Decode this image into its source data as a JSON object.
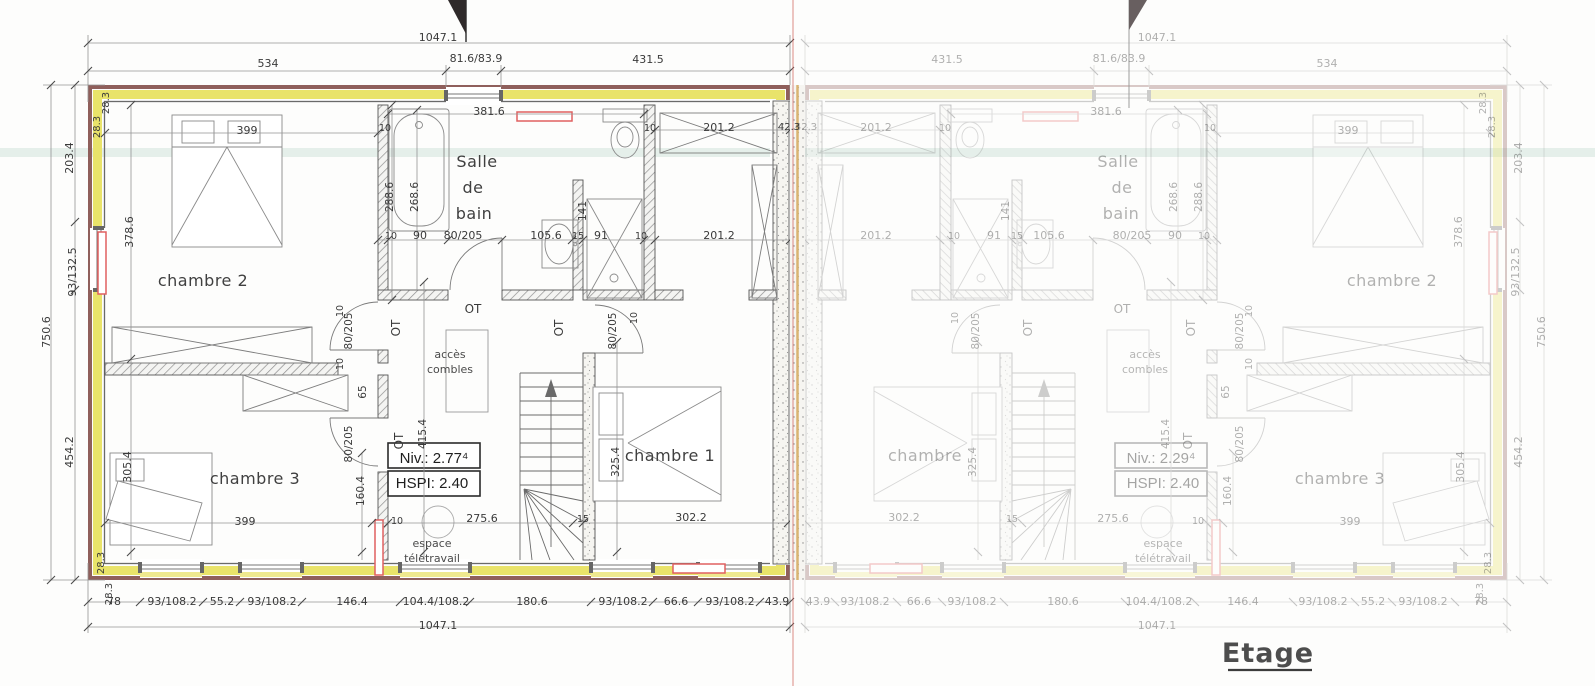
{
  "title": "Etage",
  "plan": {
    "left_unit": {
      "rooms": [
        "chambre 1",
        "chambre 2",
        "chambre 3",
        "Salle de bain"
      ],
      "level_note": "Niv.: 2.77⁴",
      "height_note": "HSPI: 2.40",
      "annotations": [
        "accès combles",
        "espace télétravail",
        "OT"
      ]
    },
    "right_unit": {
      "rooms": [
        "chambre",
        "chambre 2",
        "chambre 3",
        "Salle de bain"
      ],
      "level_note": "Niv.: 2.29⁴",
      "height_note": "HSPI: 2.40",
      "annotations": [
        "accès combles",
        "espace télétravail",
        "OT"
      ]
    }
  },
  "colors": {
    "insulation_band": "#e9e36a",
    "exterior_wall": "#8f5f5b",
    "radiator": "#e06060",
    "fold_line": "#cd5c55",
    "party_wall_line": "#d9b472"
  },
  "right_overrides": {
    "chambre 1": "chambre",
    "Niv.: 2.77⁴": "Niv.: 2.29⁴"
  },
  "labels": [
    {
      "t": "1047.1",
      "x": 438,
      "y": 41,
      "s": 11
    },
    {
      "t": "534",
      "x": 268,
      "y": 67,
      "s": 11
    },
    {
      "t": "81.6/83.9",
      "x": 476,
      "y": 62,
      "s": 11
    },
    {
      "t": "431.5",
      "x": 648,
      "y": 63,
      "s": 11
    },
    {
      "t": "28.3",
      "x": 109,
      "y": 103,
      "r": -90,
      "s": 10
    },
    {
      "t": "28.3",
      "x": 100,
      "y": 127,
      "r": -90,
      "s": 10
    },
    {
      "t": "203.4",
      "x": 73,
      "y": 158,
      "r": -90,
      "s": 11
    },
    {
      "t": "93/132.5",
      "x": 76,
      "y": 272,
      "r": -90,
      "s": 11
    },
    {
      "t": "750.6",
      "x": 50,
      "y": 332,
      "r": -90,
      "s": 11
    },
    {
      "t": "454.2",
      "x": 73,
      "y": 452,
      "r": -90,
      "s": 11
    },
    {
      "t": "28.3",
      "x": 104,
      "y": 563,
      "r": -90,
      "s": 10
    },
    {
      "t": "28.3",
      "x": 112,
      "y": 594,
      "r": -90,
      "s": 10
    },
    {
      "t": "78",
      "x": 114,
      "y": 605,
      "s": 11
    },
    {
      "t": "93/108.2",
      "x": 172,
      "y": 605,
      "s": 11
    },
    {
      "t": "55.2",
      "x": 222,
      "y": 605,
      "s": 11
    },
    {
      "t": "93/108.2",
      "x": 272,
      "y": 605,
      "s": 11
    },
    {
      "t": "146.4",
      "x": 352,
      "y": 605,
      "s": 11
    },
    {
      "t": "104.4/108.2",
      "x": 436,
      "y": 605,
      "s": 11
    },
    {
      "t": "180.6",
      "x": 532,
      "y": 605,
      "s": 11
    },
    {
      "t": "93/108.2",
      "x": 623,
      "y": 605,
      "s": 11
    },
    {
      "t": "66.6",
      "x": 676,
      "y": 605,
      "s": 11
    },
    {
      "t": "93/108.2",
      "x": 730,
      "y": 605,
      "s": 11
    },
    {
      "t": "43.9",
      "x": 777,
      "y": 605,
      "s": 11
    },
    {
      "t": "1047.1",
      "x": 438,
      "y": 629,
      "s": 11
    },
    {
      "t": "399",
      "x": 247,
      "y": 134,
      "s": 11
    },
    {
      "t": "381.6",
      "x": 489,
      "y": 115,
      "s": 11
    },
    {
      "t": "10",
      "x": 385,
      "y": 131,
      "s": 9.5
    },
    {
      "t": "10",
      "x": 650,
      "y": 131,
      "s": 9.5
    },
    {
      "t": "201.2",
      "x": 719,
      "y": 131,
      "s": 11
    },
    {
      "t": "42.3",
      "x": 789,
      "y": 130,
      "s": 10
    },
    {
      "t": "10",
      "x": 391,
      "y": 239,
      "s": 9.5
    },
    {
      "t": "90",
      "x": 420,
      "y": 239,
      "s": 11
    },
    {
      "t": "80/205",
      "x": 463,
      "y": 239,
      "s": 11
    },
    {
      "t": "105.6",
      "x": 546,
      "y": 239,
      "s": 11
    },
    {
      "t": "15",
      "x": 578,
      "y": 239,
      "s": 9.5
    },
    {
      "t": "91",
      "x": 601,
      "y": 239,
      "s": 11
    },
    {
      "t": "10",
      "x": 641,
      "y": 239,
      "s": 9.5
    },
    {
      "t": "201.2",
      "x": 719,
      "y": 239,
      "s": 11
    },
    {
      "t": "288.6",
      "x": 393,
      "y": 197,
      "r": -90,
      "s": 10.5
    },
    {
      "t": "268.6",
      "x": 418,
      "y": 197,
      "r": -90,
      "s": 10.5
    },
    {
      "t": "141",
      "x": 586,
      "y": 211,
      "r": -90,
      "s": 10.5
    },
    {
      "t": "378.6",
      "x": 133,
      "y": 232,
      "r": -90,
      "s": 11
    },
    {
      "t": "305.4",
      "x": 131,
      "y": 467,
      "r": -90,
      "s": 11
    },
    {
      "t": "Salle",
      "x": 477,
      "y": 167,
      "s": 16,
      "k": "room"
    },
    {
      "t": "de",
      "x": 473,
      "y": 193,
      "s": 16,
      "k": "room"
    },
    {
      "t": "bain",
      "x": 474,
      "y": 219,
      "s": 16,
      "k": "room"
    },
    {
      "t": "chambre 2",
      "x": 203,
      "y": 286,
      "s": 16,
      "k": "room"
    },
    {
      "t": "chambre 3",
      "x": 255,
      "y": 484,
      "s": 16,
      "k": "room"
    },
    {
      "t": "chambre 1",
      "x": 670,
      "y": 461,
      "s": 16,
      "k": "room"
    },
    {
      "t": "OT",
      "x": 473,
      "y": 313,
      "s": 12
    },
    {
      "t": "OT",
      "x": 400,
      "y": 328,
      "r": -90,
      "s": 12
    },
    {
      "t": "OT",
      "x": 563,
      "y": 328,
      "r": -90,
      "s": 12
    },
    {
      "t": "OT",
      "x": 403,
      "y": 441,
      "r": -90,
      "s": 12
    },
    {
      "t": "80/205",
      "x": 352,
      "y": 331,
      "r": -90,
      "s": 10.5
    },
    {
      "t": "80/205",
      "x": 352,
      "y": 444,
      "r": -90,
      "s": 10.5
    },
    {
      "t": "80/205",
      "x": 616,
      "y": 331,
      "r": -90,
      "s": 10.5
    },
    {
      "t": "10",
      "x": 343,
      "y": 311,
      "r": -90,
      "s": 9.5
    },
    {
      "t": "10",
      "x": 343,
      "y": 364,
      "r": -90,
      "s": 9.5
    },
    {
      "t": "65",
      "x": 366,
      "y": 392,
      "r": -90,
      "s": 10.5
    },
    {
      "t": "10",
      "x": 637,
      "y": 318,
      "r": -90,
      "s": 9.5
    },
    {
      "t": "415.4",
      "x": 426,
      "y": 434,
      "r": -90,
      "s": 10.5
    },
    {
      "t": "325.4",
      "x": 619,
      "y": 462,
      "r": -90,
      "s": 10.5
    },
    {
      "t": "160.4",
      "x": 364,
      "y": 491,
      "r": -90,
      "s": 10.5
    },
    {
      "t": "10",
      "x": 397,
      "y": 524,
      "s": 9.5
    },
    {
      "t": "275.6",
      "x": 482,
      "y": 522,
      "s": 11
    },
    {
      "t": "15",
      "x": 583,
      "y": 522,
      "s": 9.5
    },
    {
      "t": "302.2",
      "x": 691,
      "y": 521,
      "s": 11
    },
    {
      "t": "399",
      "x": 245,
      "y": 525,
      "s": 11
    },
    {
      "t": "Niv.: 2.77⁴",
      "x": 434,
      "y": 463,
      "s": 15,
      "k": "niv"
    },
    {
      "t": "HSPI: 2.40",
      "x": 432,
      "y": 488,
      "s": 15,
      "k": "niv"
    },
    {
      "t": "accès",
      "x": 450,
      "y": 358,
      "s": 11,
      "k": "note"
    },
    {
      "t": "combles",
      "x": 450,
      "y": 373,
      "s": 11,
      "k": "note"
    },
    {
      "t": "espace",
      "x": 432,
      "y": 547,
      "s": 11,
      "k": "note"
    },
    {
      "t": "télétravail",
      "x": 432,
      "y": 562,
      "s": 11,
      "k": "note"
    }
  ]
}
